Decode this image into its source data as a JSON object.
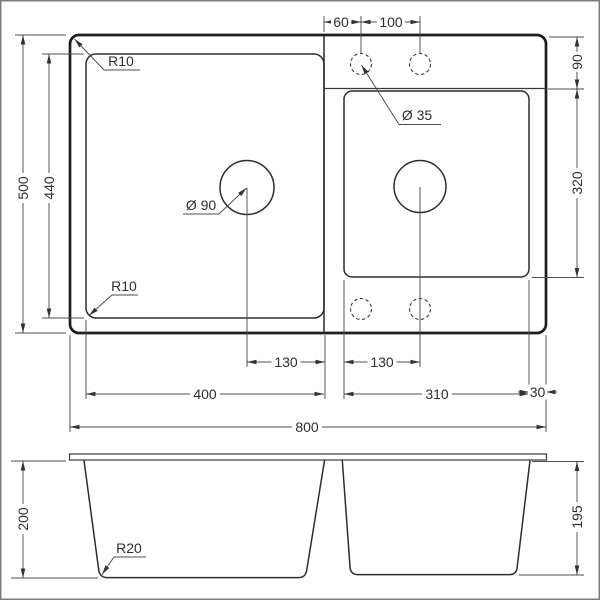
{
  "drawing_type": "sink-technical-drawing",
  "colors": {
    "ink": "#2e2e2e",
    "background": "#ffffff"
  },
  "plan": {
    "dim_overall_width": "800",
    "dim_overall_depth": "500",
    "dim_inner_depth": "440",
    "dim_left_bowl_width": "400",
    "dim_right_bowl_width": "310",
    "dim_right_margin": "30",
    "dim_tap_offset": "60",
    "dim_tap_spacing": "100",
    "dim_deck_depth": "90",
    "dim_right_bowl_depth": "320",
    "dim_left_drain_offset": "130",
    "dim_right_drain_offset": "130",
    "label_outer_corner_radius": "R10",
    "label_inner_corner_radius": "R10",
    "label_tap_hole_diameter": "Ø 35",
    "label_drain_diameter": "Ø 90"
  },
  "side": {
    "dim_left_bowl_depth": "200",
    "dim_right_bowl_depth": "195",
    "label_bottom_radius": "R20"
  }
}
